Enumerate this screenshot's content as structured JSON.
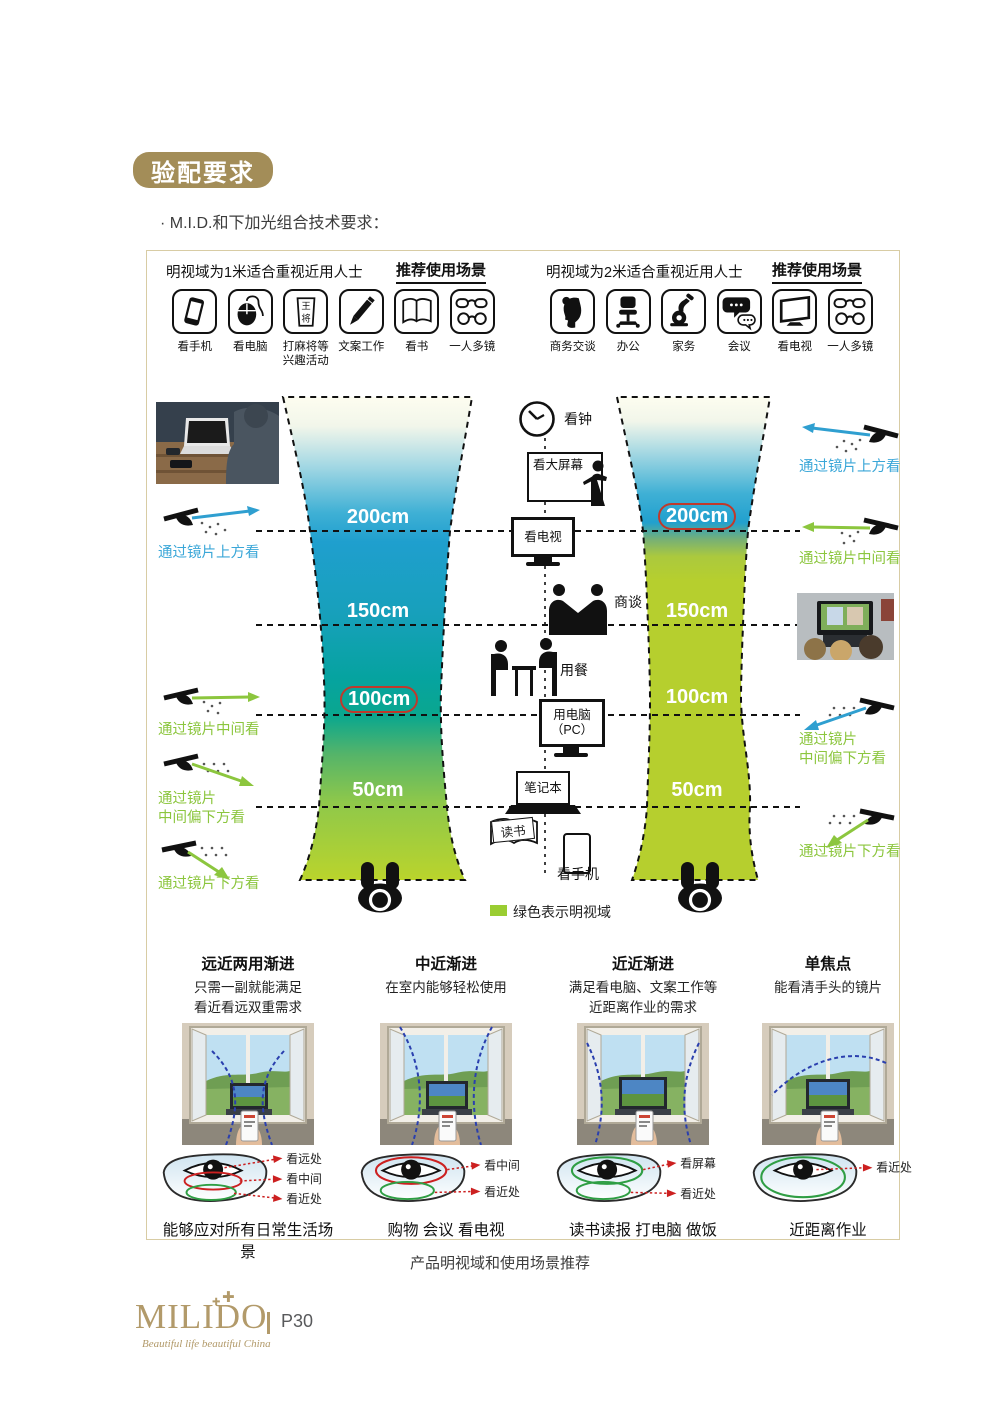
{
  "page": {
    "badge": "验配要求",
    "tech_note": "· M.I.D.和下加光组合技术要求：",
    "diagram_caption": "产品明视域和使用场景推荐"
  },
  "footer": {
    "logo_text": "MILIDO",
    "logo_tagline": "Beautiful life beautiful China",
    "page_number": "P30"
  },
  "scenarios": {
    "left": {
      "title": "明视域为1米适合重视近用人士",
      "recommend_label": "推荐使用场景",
      "mahjong_char_top": "王",
      "mahjong_char_bottom": "将",
      "icons": [
        {
          "label": "看手机"
        },
        {
          "label": "看电脑"
        },
        {
          "label": "打麻将等\n兴趣活动"
        },
        {
          "label": "文案工作"
        },
        {
          "label": "看书"
        },
        {
          "label": "一人多镜"
        }
      ]
    },
    "right": {
      "title": "明视域为2米适合重视近用人士",
      "recommend_label": "推荐使用场景",
      "icons": [
        {
          "label": "商务交谈"
        },
        {
          "label": "办公"
        },
        {
          "label": "家务"
        },
        {
          "label": "会议"
        },
        {
          "label": "看电视"
        },
        {
          "label": "一人多镜"
        }
      ]
    }
  },
  "diagram": {
    "left_distances": {
      "d200": "200cm",
      "d150": "150cm",
      "d100": "100cm",
      "d50": "50cm",
      "highlighted": "100cm"
    },
    "right_distances": {
      "d200": "200cm",
      "d150": "150cm",
      "d100": "100cm",
      "d50": "50cm",
      "highlighted": "200cm"
    },
    "activities": {
      "clock": "看钟",
      "big_screen": "看大屏幕",
      "tv": "看电视",
      "negotiate": "商谈",
      "dining": "用餐",
      "pc": "用电脑\n（PC）",
      "laptop": "笔记本",
      "reading": "读书",
      "phone": "看手机"
    },
    "annotations_left": {
      "top": "通过镜片上方看",
      "middle": "通过镜片中间看",
      "mid_lower": "通过镜片\n中间偏下方看",
      "lower": "通过镜片下方看"
    },
    "annotations_right": {
      "top": "通过镜片上方看",
      "middle": "通过镜片中间看",
      "mid_lower": "通过镜片\n中间偏下方看",
      "lower": "通过镜片下方看"
    },
    "legend": "绿色表示明视域"
  },
  "lens_types": [
    {
      "title": "远近两用渐进",
      "desc": "只需一副就能满足\n看近看远双重需求",
      "zone1": "看远处",
      "zone2": "看中间",
      "zone3": "看近处",
      "caption": "能够应对所有日常生活场景"
    },
    {
      "title": "中近渐进",
      "desc": "在室内能够轻松使用",
      "zone1": "看中间",
      "zone2": "看近处",
      "caption": "购物 会议 看电视"
    },
    {
      "title": "近近渐进",
      "desc": "满足看电脑、文案工作等\n近距离作业的需求",
      "zone1": "看屏幕",
      "zone2": "看近处",
      "caption": "读书读报 打电脑 做饭"
    },
    {
      "title": "单焦点",
      "desc": "能看清手头的镜片",
      "zone1": "看近处",
      "caption": "近距离作业"
    }
  ],
  "colors": {
    "badge_gold": "#a38d58",
    "logo_gold": "#b29a6a",
    "annotation_blue": "#3ba7d8",
    "annotation_green": "#8cc63e",
    "highlight_red": "#c0392b",
    "legend_green": "#9acd32"
  }
}
